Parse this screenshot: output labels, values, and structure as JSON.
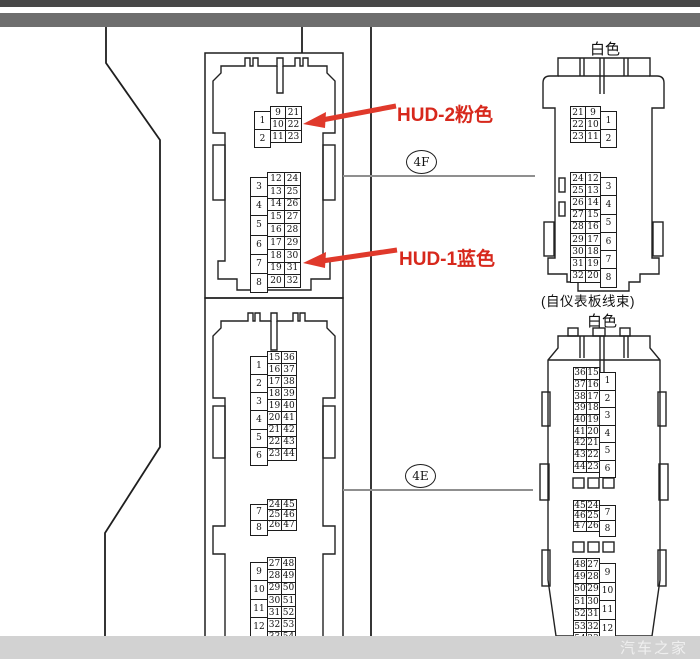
{
  "page": {
    "watermark": "汽车之家"
  },
  "labels": {
    "hud2": "HUD-2粉色",
    "hud1": "HUD-1蓝色",
    "connector_4f": "4F",
    "connector_4e": "4E",
    "white_top": "白色",
    "white_bottom": "白色",
    "harness_note": "(自仪表板线束)"
  },
  "colors": {
    "annotation_red": "#d7281c",
    "line_dark": "#1f1f1f",
    "leader_gray": "#8f8f8f",
    "top_bar_dark": "#474747",
    "top_bar_mid": "#6e6e6e",
    "bottom_bar": "#d2d2d2"
  },
  "connectors": {
    "hud_left": {
      "blocks": [
        {
          "tall_side": "left",
          "tall": [
            "1",
            "2"
          ],
          "colA": [
            "9",
            "10",
            "11"
          ],
          "colB": [
            "21",
            "22",
            "23"
          ]
        },
        {
          "tall_side": "left",
          "tall": [
            "3",
            "4",
            "5",
            "6",
            "7",
            "8"
          ],
          "colA": [
            "12",
            "13",
            "14",
            "15",
            "16",
            "17",
            "18",
            "19",
            "20"
          ],
          "colB": [
            "24",
            "25",
            "26",
            "27",
            "28",
            "29",
            "30",
            "31",
            "32"
          ]
        }
      ]
    },
    "main_left": {
      "blocks": [
        {
          "tall_side": "left",
          "tall": [
            "1",
            "2",
            "3",
            "4",
            "5",
            "6"
          ],
          "colA": [
            "15",
            "16",
            "17",
            "18",
            "19",
            "20",
            "21",
            "22",
            "23"
          ],
          "colB": [
            "36",
            "37",
            "38",
            "39",
            "40",
            "41",
            "42",
            "43",
            "44"
          ]
        },
        {
          "tall_side": "left",
          "tall": [
            "7",
            "8"
          ],
          "colA": [
            "24",
            "25",
            "26"
          ],
          "colB": [
            "45",
            "46",
            "47"
          ]
        },
        {
          "tall_side": "left",
          "tall": [
            "9",
            "10",
            "11",
            "12"
          ],
          "colA": [
            "27",
            "28",
            "29",
            "30",
            "31",
            "32",
            "33"
          ],
          "colB": [
            "48",
            "49",
            "50",
            "51",
            "52",
            "53",
            "54"
          ]
        }
      ]
    },
    "white_top_right": {
      "blocks": [
        {
          "tall_side": "right",
          "tall": [
            "1",
            "2"
          ],
          "colA": [
            "21",
            "22",
            "23"
          ],
          "colB": [
            "9",
            "10",
            "11"
          ]
        },
        {
          "tall_side": "right",
          "tall": [
            "3",
            "4",
            "5",
            "6",
            "7",
            "8"
          ],
          "colA": [
            "24",
            "25",
            "26",
            "27",
            "28",
            "29",
            "30",
            "31",
            "32"
          ],
          "colB": [
            "12",
            "13",
            "14",
            "15",
            "16",
            "17",
            "18",
            "19",
            "20"
          ]
        }
      ]
    },
    "white_bottom_right": {
      "blocks": [
        {
          "tall_side": "right",
          "tall": [
            "1",
            "2",
            "3",
            "4",
            "5",
            "6"
          ],
          "colA": [
            "36",
            "37",
            "38",
            "39",
            "40",
            "41",
            "42",
            "43",
            "44"
          ],
          "colB": [
            "15",
            "16",
            "17",
            "18",
            "19",
            "20",
            "21",
            "22",
            "23"
          ]
        },
        {
          "tall_side": "right",
          "tall": [
            "7",
            "8"
          ],
          "colA": [
            "45",
            "46",
            "47"
          ],
          "colB": [
            "24",
            "25",
            "26"
          ]
        },
        {
          "tall_side": "right",
          "tall": [
            "9",
            "10",
            "11",
            "12"
          ],
          "colA": [
            "48",
            "49",
            "50",
            "51",
            "52",
            "53",
            "54"
          ],
          "colB": [
            "27",
            "28",
            "29",
            "30",
            "31",
            "32",
            "33"
          ]
        }
      ]
    }
  }
}
